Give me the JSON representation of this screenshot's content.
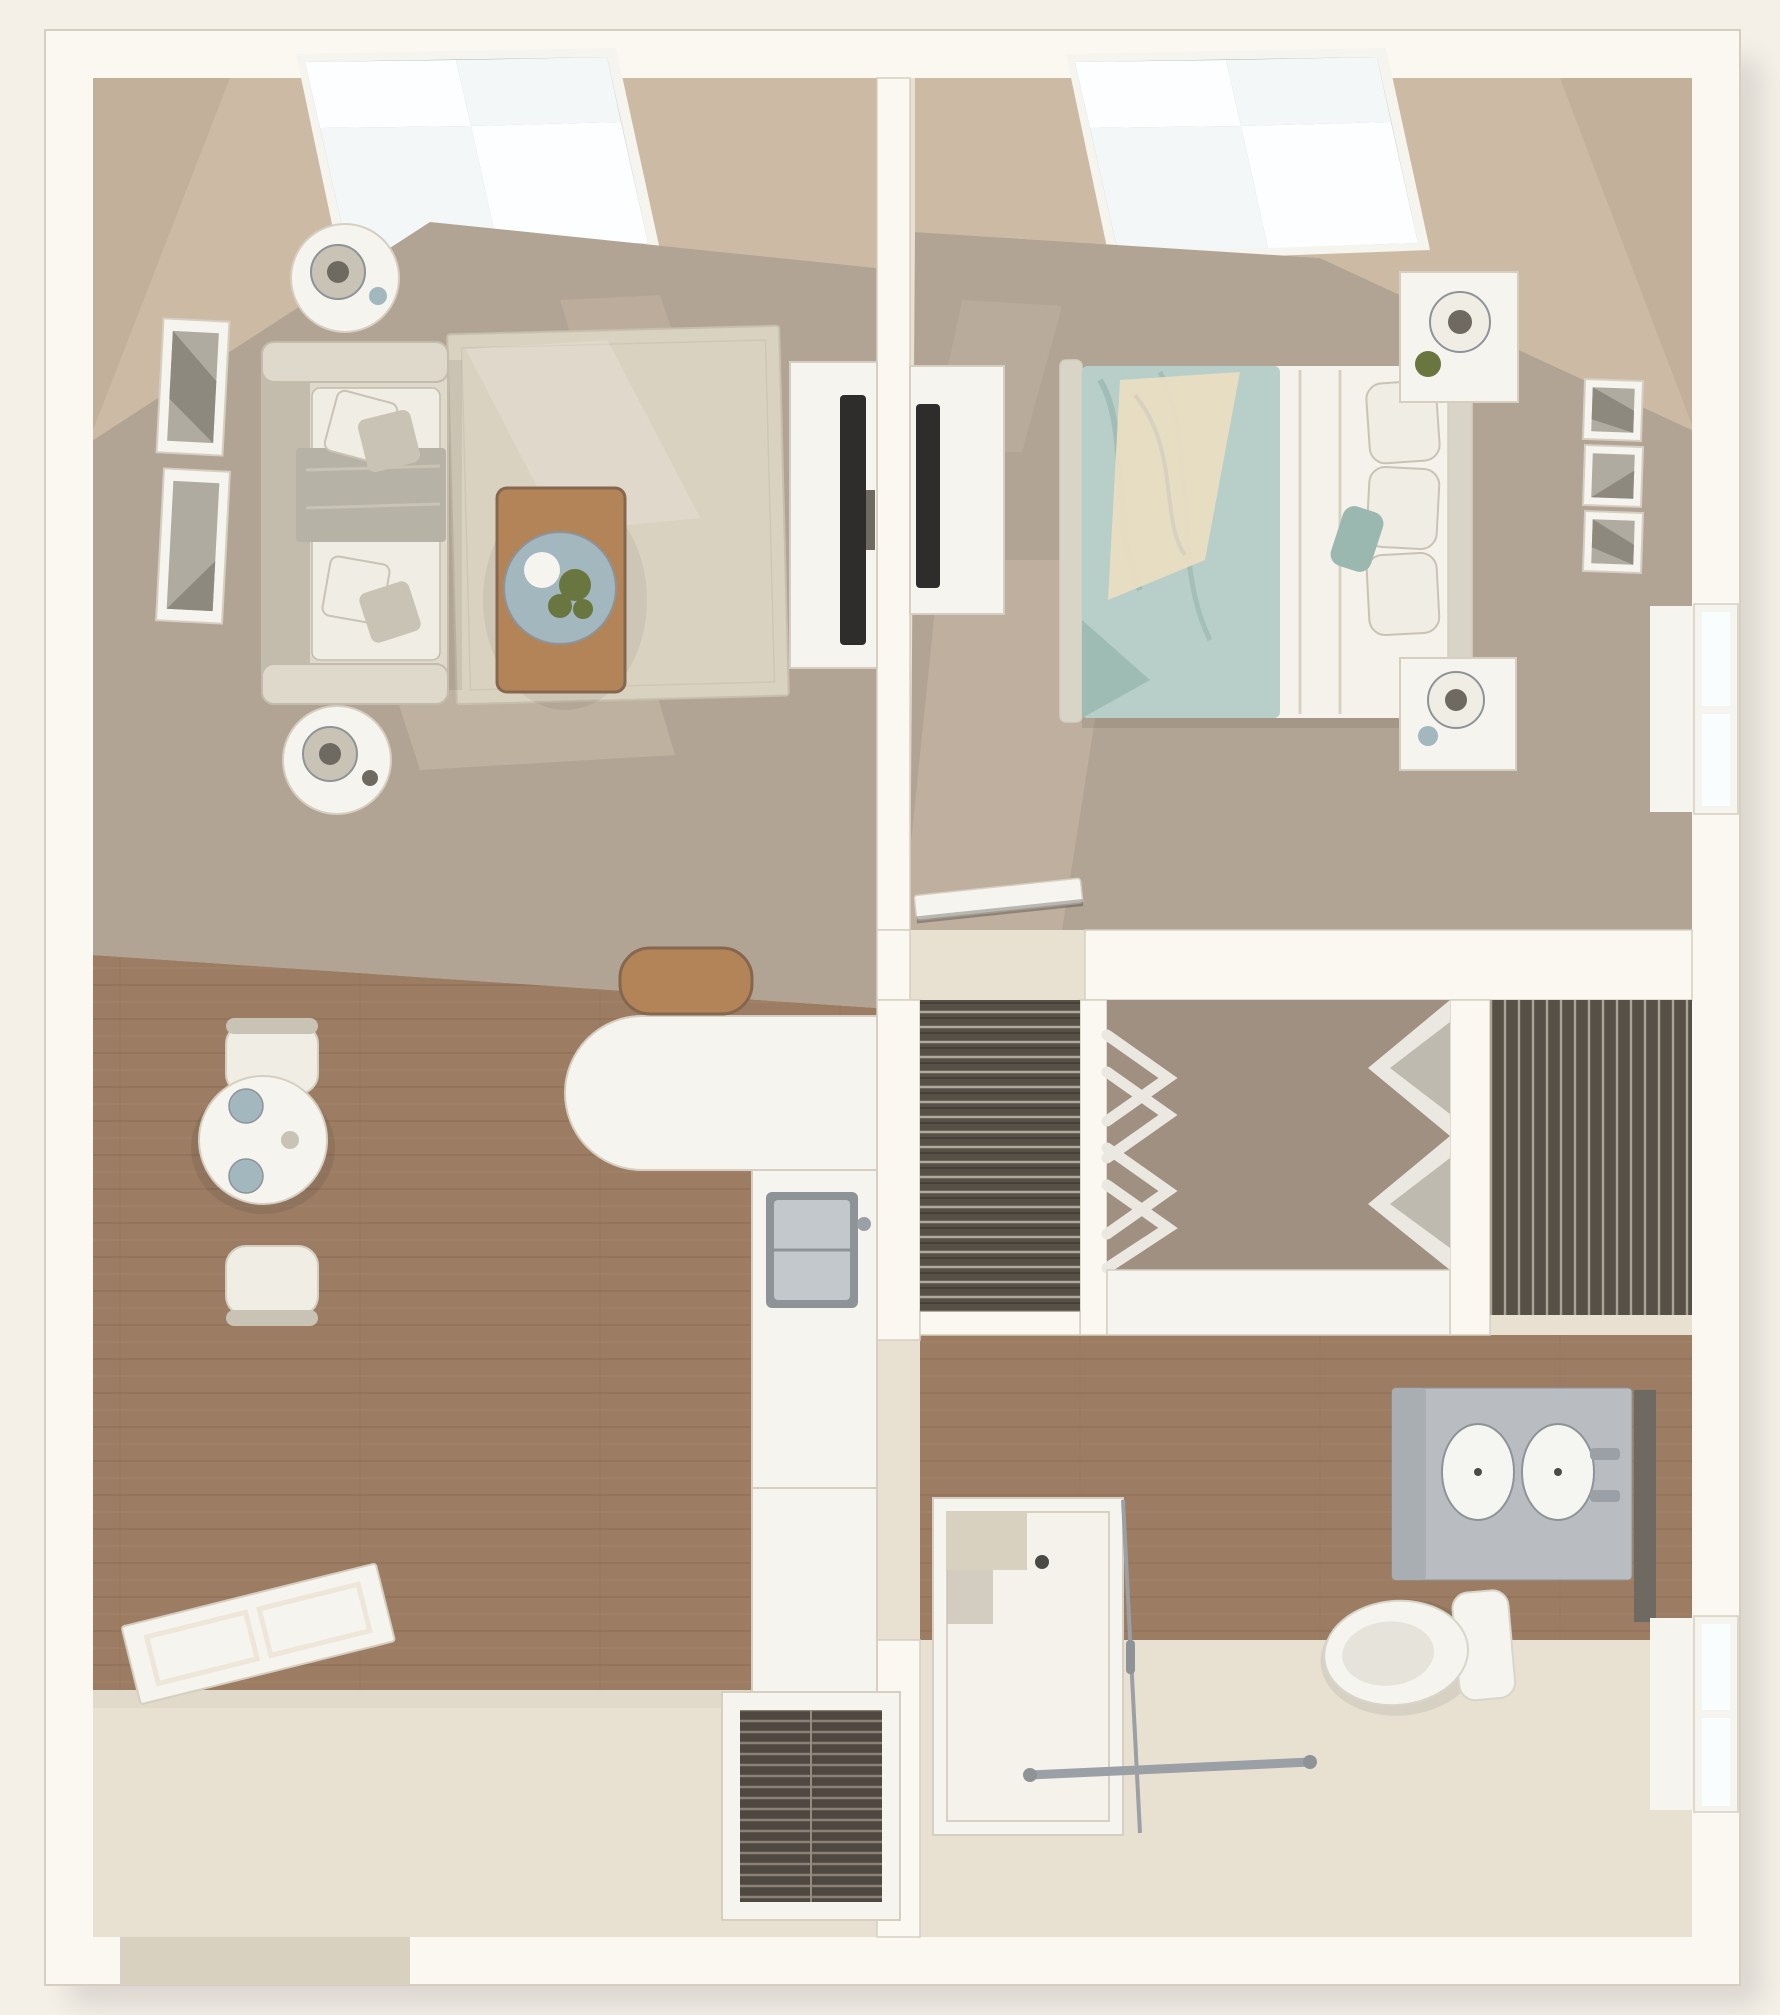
{
  "scene": {
    "kind": "3d-floor-plan-top-view",
    "unit": "one-bedroom one-bath apartment",
    "text_visible": false
  },
  "palette": {
    "pageBg": "#f4efe7",
    "wall": "#fbf8f2",
    "wallShade": "#eee7d9",
    "wallEdge": "#d6cfc1",
    "slope": "#cdbaa4",
    "slopeShade": "#b9a58e",
    "skylightPane": "#f3f7f8",
    "skylightBright": "#fdfeff",
    "mullion": "#a6adb3",
    "carpet": "#b2a494",
    "carpetSun": "#cbbdab",
    "rug": "#dad2c1",
    "rugShade": "#c7bfad",
    "wood": "#9c7d64",
    "woodDark": "#85664e",
    "woodLight": "#ad8f74",
    "tile": "#e8e1d2",
    "tileShade": "#d9d1bf",
    "sofa": "#dfd9cc",
    "sofaShade": "#c3bcac",
    "pillow": "#f0ede5",
    "pillowGrey": "#c9c3b5",
    "throw": "#b7b2a6",
    "tableWood": "#b28457",
    "tray": "#a3b7bf",
    "plant": "#6a7640",
    "white": "#f6f4ee",
    "tv": "#2e2d2c",
    "duvet": "#b7cfc8",
    "duvetShade": "#9bb8b0",
    "blanket": "#e9ddc3",
    "sheet": "#f4f2ea",
    "headboard": "#d9d4c8",
    "closetDark": "#575046",
    "closetStripe": "#cdc7bb",
    "closetFloor": "#a09081",
    "clothes": "#eae8e0",
    "clothesShade": "#b3aea3",
    "counterGrey": "#b9bdc1",
    "cabinetGrey": "#a9aeb3",
    "sinkWhite": "#f5f5f1",
    "chrome": "#9aa0a5",
    "steel": "#c3c8cc",
    "steelRim": "#8e9398",
    "mirror": "#6e6a61",
    "toilet": "#f5f4ef",
    "toiletShade": "#d8d5ca",
    "drain": "#4a4a46",
    "louver": "#4f4840",
    "louverSlat": "#948c7f",
    "windowPane": "#fafdfd",
    "frameArt": "#b0aba1",
    "frameArtDark": "#8e897f"
  },
  "rooms": {
    "living_room": {
      "furniture": [
        "sofa-with-pillows",
        "side-table-lamp-top",
        "side-table-lamp-bottom",
        "wall-art-frames",
        "area-rug",
        "coffee-table",
        "plant-tray",
        "tv-console",
        "flat-tv"
      ]
    },
    "bedroom": {
      "furniture": [
        "queen-bed-teal-bedding",
        "headboard",
        "nightstand-top",
        "nightstand-bottom",
        "table-lamps",
        "wall-art-frames",
        "dresser",
        "flat-tv",
        "window",
        "open-door"
      ]
    },
    "kitchen_dining": {
      "furniture": [
        "round-dining-table",
        "dining-chairs",
        "curved-peninsula-counter",
        "kitchen-sink",
        "base-cabinets",
        "wood-basket",
        "entry-door",
        "hvac-louver-closet"
      ]
    },
    "bathroom_closets": {
      "furniture": [
        "wire-shelf-closet-left",
        "hanging-clothes-closet",
        "folded-clothes-shelves",
        "wire-shelf-closet-right",
        "shelf-counter",
        "double-sink-vanity",
        "vanity-mirror",
        "toilet",
        "walk-in-shower-with-bench",
        "shower-glass",
        "grab-bar",
        "window"
      ]
    },
    "features": [
      "skylight-living",
      "skylight-bedroom"
    ]
  }
}
